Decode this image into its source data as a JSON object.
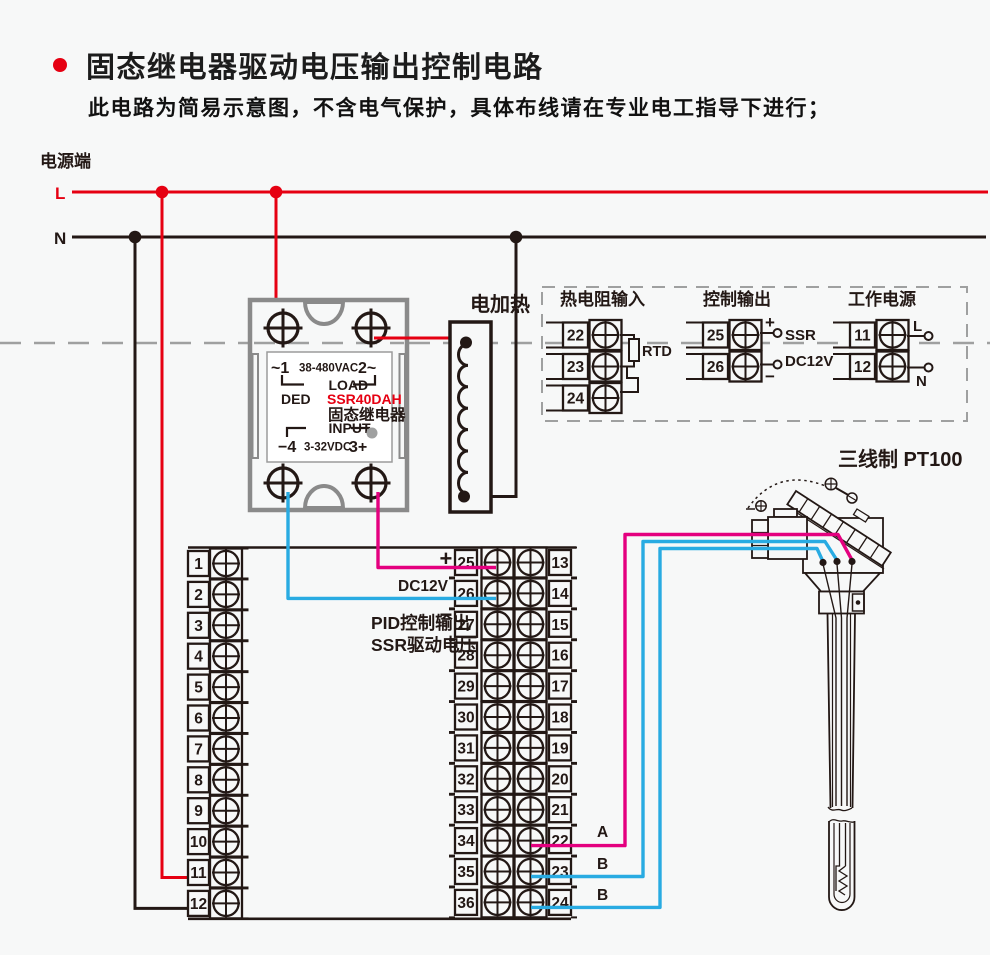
{
  "header": {
    "title": "固态继电器驱动电压输出控制电路",
    "subtitle": "此电路为简易示意图，不含电气保护，具体布线请在专业电工指导下进行；"
  },
  "power": {
    "label": "电源端",
    "live": "L",
    "neutral": "N"
  },
  "ssr": {
    "line1_left": "~1",
    "line1_mid": "38-480VAC",
    "line1_right": "2~",
    "load_label": "LOAD",
    "brand": "DED",
    "model": "SSR40DAH",
    "name": "固态继电器",
    "input_label": "INPUT",
    "input_left": "−4",
    "input_mid": "3-32VDC",
    "input_right": "3+"
  },
  "heater": {
    "label": "电加热"
  },
  "io_panel": {
    "rtd": {
      "title": "热电阻输入",
      "terminals": [
        "22",
        "23",
        "24"
      ],
      "component": "RTD"
    },
    "output": {
      "title": "控制输出",
      "terminals": [
        "25",
        "26"
      ],
      "plus": "+",
      "minus": "−",
      "line1": "SSR",
      "line2": "DC12V"
    },
    "supply": {
      "title": "工作电源",
      "terminals": [
        "11",
        "12"
      ],
      "live": "L",
      "neutral": "N"
    }
  },
  "strip": {
    "left": [
      "1",
      "2",
      "3",
      "4",
      "5",
      "6",
      "7",
      "8",
      "9",
      "10",
      "11",
      "12"
    ],
    "inner": [
      "25",
      "26",
      "27",
      "28",
      "29",
      "30",
      "31",
      "32",
      "33",
      "34",
      "35",
      "36"
    ],
    "outer": [
      "13",
      "14",
      "15",
      "16",
      "17",
      "18",
      "19",
      "20",
      "21",
      "22",
      "23",
      "24"
    ],
    "plus": "+",
    "minus": "−",
    "dc_label": "DC12V",
    "note_line1": "PID控制输出",
    "note_line2": "SSR驱动电压",
    "wire_a": "A",
    "wire_b1": "B",
    "wire_b2": "B"
  },
  "sensor": {
    "label": "三线制 PT100"
  },
  "colors": {
    "red": "#e60012",
    "magenta": "#e4007f",
    "blue": "#29abe2",
    "dark": "#231815",
    "gray": "#9fa0a0",
    "ssr_gray": "#8a8a8a",
    "led": "#9fa0a0",
    "bg": "#f7f8f8"
  }
}
